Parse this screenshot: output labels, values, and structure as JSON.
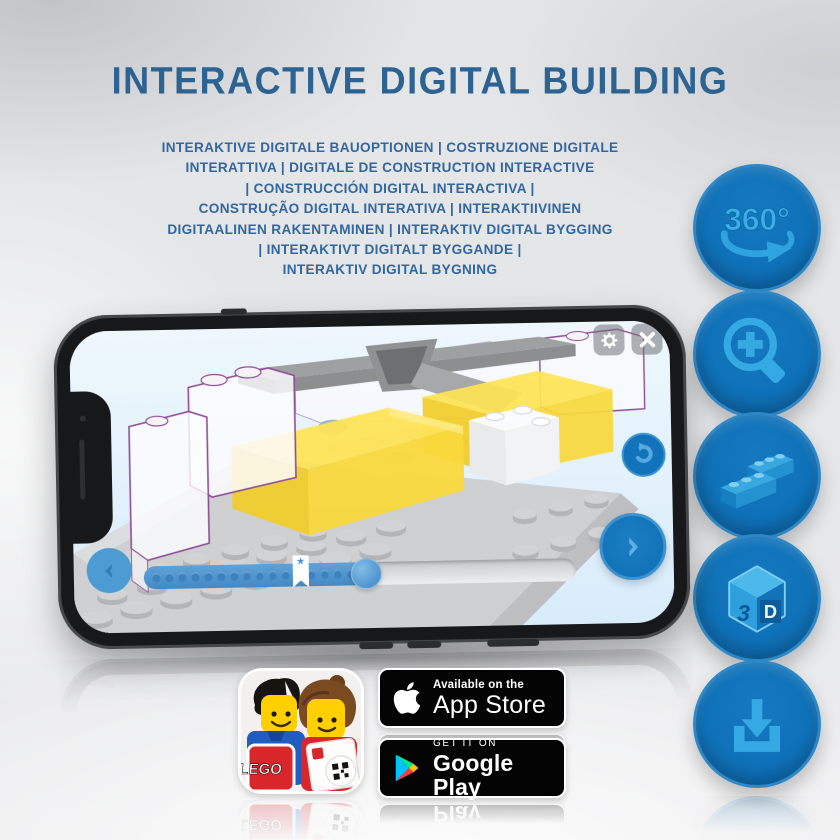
{
  "header": {
    "title": "INTERACTIVE DIGITAL BUILDING",
    "subtitle_lines": [
      "INTERAKTIVE DIGITALE BAUOPTIONEN | COSTRUZIONE DIGITALE",
      "INTERATTIVA | DIGITALE DE CONSTRUCTION INTERACTIVE",
      "| CONSTRUCCIÓN DIGITAL INTERACTIVA |",
      "CONSTRUÇÃO DIGITAL INTERATIVA | INTERAKTIIVINEN",
      "DIGITAALINEN RAKENTAMINEN | INTERAKTIV DIGITAL BYGGING",
      "| INTERAKTIVT DIGITALT BYGGANDE |",
      "INTERAKTIV DIGITAL BYGNING"
    ]
  },
  "feature_rail": {
    "rotation_label": "360°",
    "cube_digit": "3",
    "cube_letter": "D"
  },
  "phone": {
    "progress_marker_star": "★"
  },
  "badges": {
    "lego_app_logo": "LEGO",
    "app_store": {
      "tagline": "Available on the",
      "store": "App Store"
    },
    "google_play": {
      "tagline": "GET IT ON",
      "store": "Google Play"
    }
  },
  "colors": {
    "heading_blue": "#2c6392",
    "subtitle_blue": "#33679e",
    "circle_blue": "#0f72b9",
    "icon_light_blue": "#35a9e3",
    "brick_yellow": "#f7d93e",
    "screen_sky": "#e3f2fc",
    "badge_black": "#040404"
  }
}
